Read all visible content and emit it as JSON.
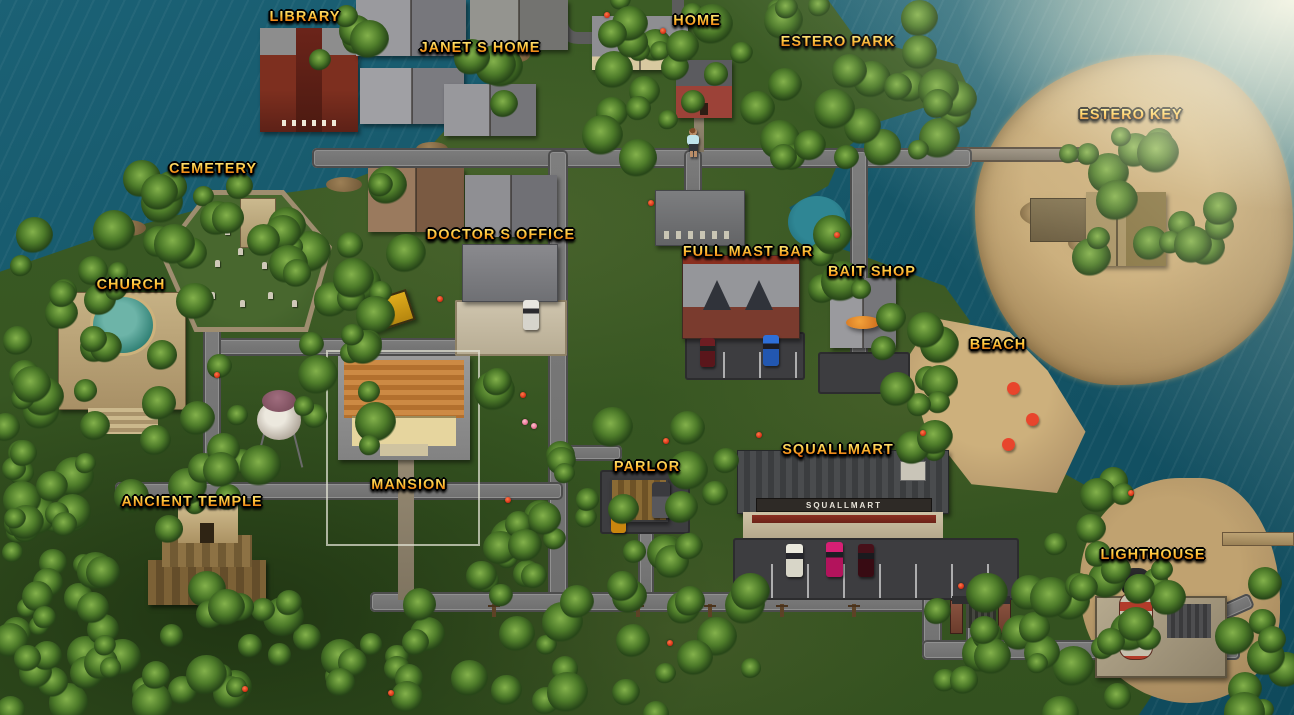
{
  "map": {
    "locations": [
      {
        "id": "library",
        "label": "LIBRARY",
        "x": 305,
        "y": 9
      },
      {
        "id": "janets-home",
        "label": "JANET S HOME",
        "x": 480,
        "y": 40
      },
      {
        "id": "home",
        "label": "HOME",
        "x": 697,
        "y": 13
      },
      {
        "id": "estero-park",
        "label": "ESTERO PARK",
        "x": 838,
        "y": 34
      },
      {
        "id": "estero-key",
        "label": "ESTERO KEY",
        "x": 1131,
        "y": 107
      },
      {
        "id": "cemetery",
        "label": "CEMETERY",
        "x": 213,
        "y": 161
      },
      {
        "id": "doctors-office",
        "label": "DOCTOR S OFFICE",
        "x": 501,
        "y": 227
      },
      {
        "id": "full-mast-bar",
        "label": "FULL MAST BAR",
        "x": 748,
        "y": 244
      },
      {
        "id": "bait-shop",
        "label": "BAIT SHOP",
        "x": 872,
        "y": 264
      },
      {
        "id": "church",
        "label": "CHURCH",
        "x": 131,
        "y": 277
      },
      {
        "id": "beach",
        "label": "BEACH",
        "x": 998,
        "y": 337
      },
      {
        "id": "squallmart",
        "label": "SQUALLMART",
        "x": 838,
        "y": 442
      },
      {
        "id": "mansion",
        "label": "MANSION",
        "x": 409,
        "y": 477
      },
      {
        "id": "parlor",
        "label": "PARLOR",
        "x": 647,
        "y": 459
      },
      {
        "id": "ancient-temple",
        "label": "ANCIENT TEMPLE",
        "x": 192,
        "y": 494
      },
      {
        "id": "lighthouse",
        "label": "LIGHTHOUSE",
        "x": 1153,
        "y": 547
      }
    ],
    "player": {
      "present": true,
      "x": 686,
      "y": 128
    }
  },
  "signs": {
    "squallmart_storefront": "SQUALLMART"
  },
  "colors": {
    "ocean": "#155668",
    "grass": "#35521f",
    "sand": "#b2956a",
    "road": "#767676",
    "label_gold": "#ffc63a",
    "label_shadow": "#000000",
    "umbrella_red": "#c0291a"
  }
}
